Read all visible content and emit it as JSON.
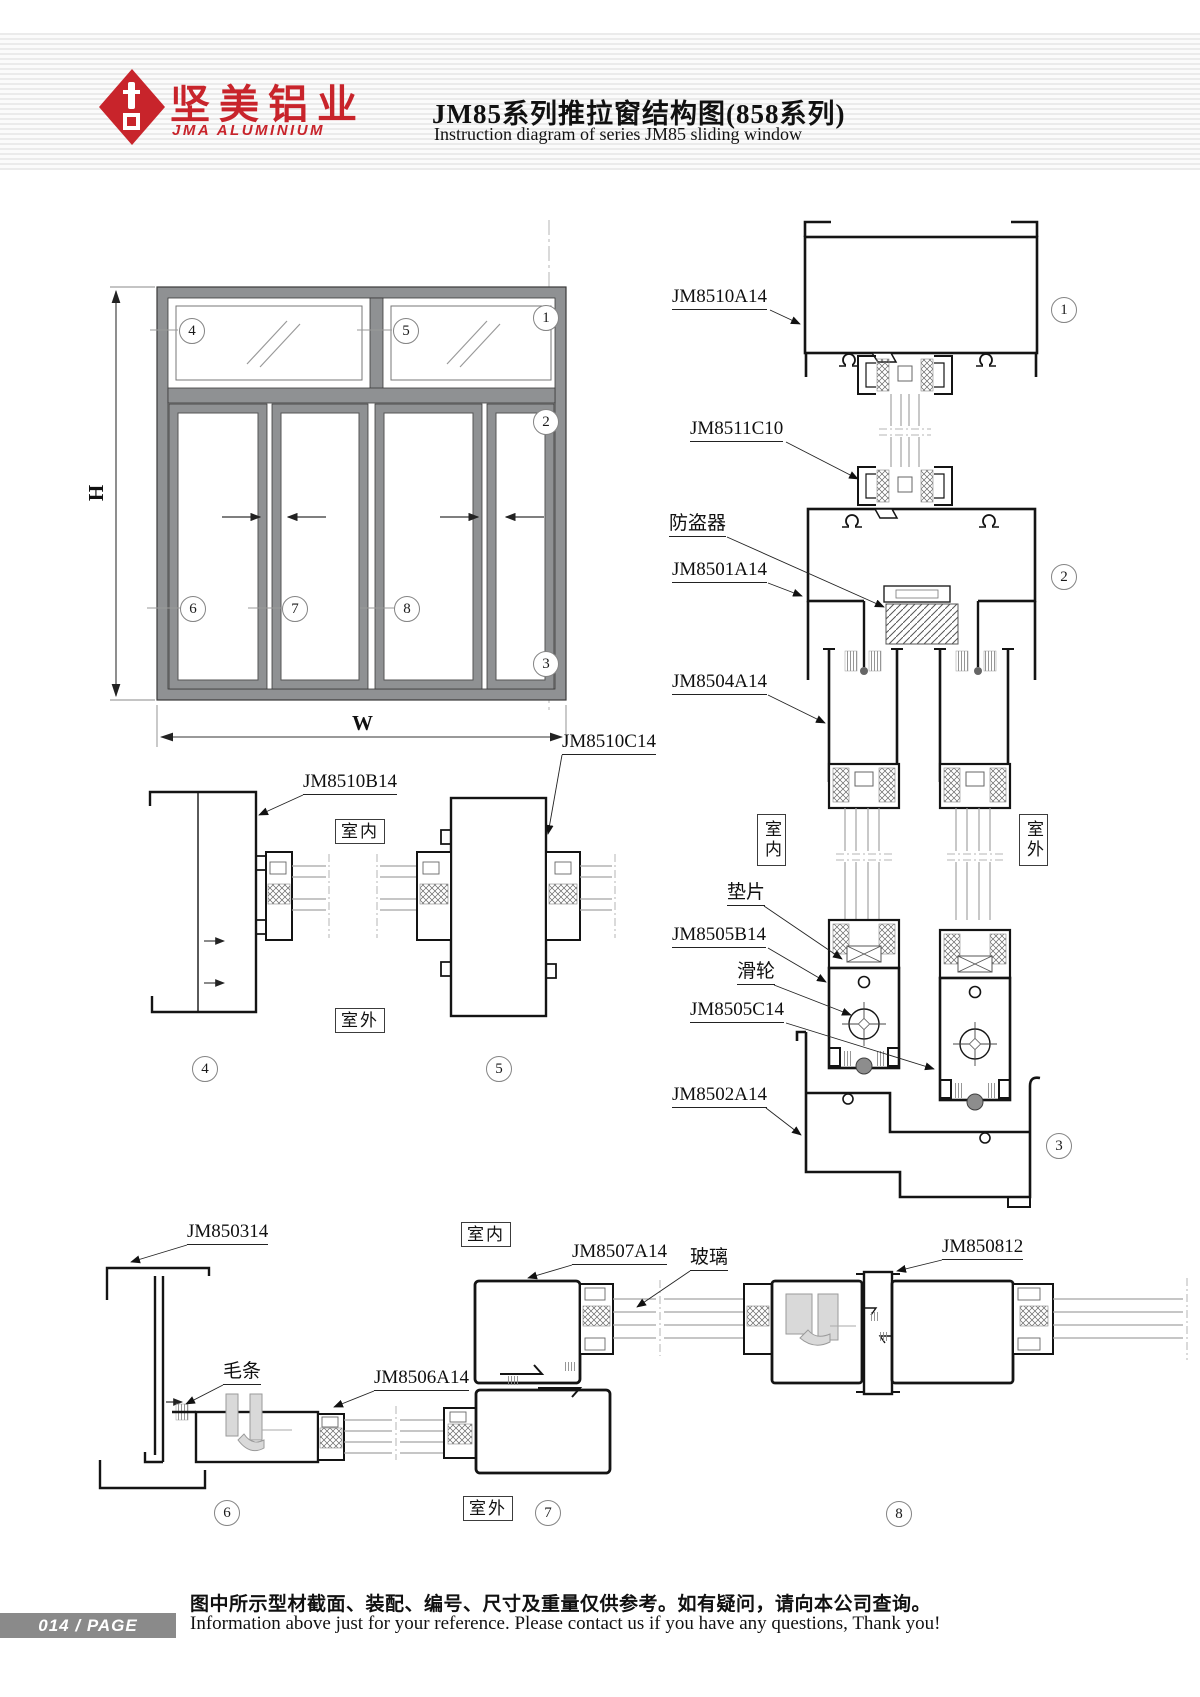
{
  "header": {
    "logo_cn": "坚美铝业",
    "logo_en": "JMA ALUMINIUM",
    "title_cn": "JM85系列推拉窗结构图(858系列)",
    "title_en": "Instruction diagram of series JM85 sliding window"
  },
  "dims": {
    "h": "H",
    "w": "W"
  },
  "rooms": {
    "in": "室内",
    "out": "室外"
  },
  "parts": {
    "jm8510a14": "JM8510A14",
    "jm8511c10": "JM8511C10",
    "fangdaoqi": "防盗器",
    "jm8501a14": "JM8501A14",
    "jm8504a14": "JM8504A14",
    "dianpian": "垫片",
    "hualun": "滑轮",
    "jm8505b14": "JM8505B14",
    "jm8505c14": "JM8505C14",
    "jm8502a14": "JM8502A14",
    "jm8510b14": "JM8510B14",
    "jm8510c14": "JM8510C14",
    "jm850314": "JM850314",
    "maotiao": "毛条",
    "jm8506a14": "JM8506A14",
    "jm8507a14": "JM8507A14",
    "boli": "玻璃",
    "jm850812": "JM850812"
  },
  "nums": {
    "n1": "1",
    "n2": "2",
    "n3": "3",
    "n4": "4",
    "n5": "5",
    "n6": "6",
    "n7": "7",
    "n8": "8"
  },
  "footer": {
    "page_num": "014",
    "sep": "/",
    "page_word": "PAGE",
    "note_cn": "图中所示型材截面、装配、编号、尺寸及重量仅供参考。如有疑问，请向本公司查询。",
    "note_en": "Information above just for your reference. Please contact us if you have any questions, Thank you!"
  },
  "colors": {
    "accent": "#c8242b",
    "frame_gray": "#8f9193",
    "footer_gray": "#8a8a8a"
  }
}
